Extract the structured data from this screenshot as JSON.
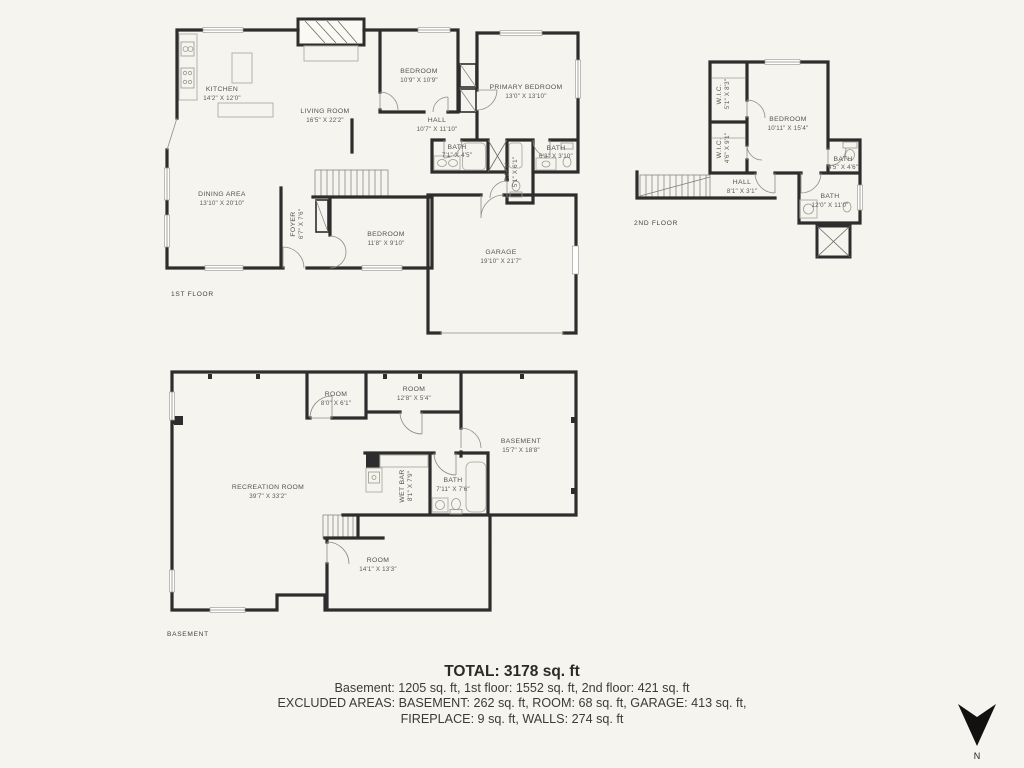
{
  "colors": {
    "background": "#f5f4ee",
    "wall": "#2d2d2d",
    "room_label": "#54544c"
  },
  "floors": {
    "first": {
      "label": "1ST FLOOR",
      "rooms": [
        {
          "name": "KITCHEN",
          "dims": "14'2\" X 12'0\""
        },
        {
          "name": "LIVING ROOM",
          "dims": "16'5\" X 22'2\""
        },
        {
          "name": "DINING AREA",
          "dims": "13'10\" X 20'10\""
        },
        {
          "name": "FOYER",
          "dims": "6'7\" X 7'6\""
        },
        {
          "name": "BEDROOM",
          "dims": "11'8\" X 9'10\""
        },
        {
          "name": "BEDROOM",
          "dims": "10'9\" X 10'9\""
        },
        {
          "name": "PRIMARY BEDROOM",
          "dims": "13'0\" X 13'10\""
        },
        {
          "name": "HALL",
          "dims": "10'7\" X 11'10\""
        },
        {
          "name": "BATH",
          "dims": "7'1\" X 4'5\""
        },
        {
          "name": "BATH",
          "dims": "5'1\" X 6'1\""
        },
        {
          "name": "BATH",
          "dims": "6'3\" X 3'10\""
        },
        {
          "name": "GARAGE",
          "dims": "19'10\" X 21'7\""
        }
      ]
    },
    "second": {
      "label": "2ND FLOOR",
      "rooms": [
        {
          "name": "W.I.C.",
          "dims": "5'1\" X 8'3\""
        },
        {
          "name": "W.I.C.",
          "dims": "4'6\" X 9'1\""
        },
        {
          "name": "BEDROOM",
          "dims": "10'11\" X 15'4\""
        },
        {
          "name": "HALL",
          "dims": "8'1\" X 3'1\""
        },
        {
          "name": "BATH",
          "dims": "4'5\" X 4'6\""
        },
        {
          "name": "BATH",
          "dims": "12'0\" X 11'0\""
        }
      ]
    },
    "basement": {
      "label": "BASEMENT",
      "rooms": [
        {
          "name": "ROOM",
          "dims": "8'0\" X 6'1\""
        },
        {
          "name": "ROOM",
          "dims": "12'8\" X 5'4\""
        },
        {
          "name": "RECREATION ROOM",
          "dims": "39'7\" X 33'2\""
        },
        {
          "name": "WET BAR",
          "dims": "8'1\" X 7'9\""
        },
        {
          "name": "BATH",
          "dims": "7'11\" X 7'6\""
        },
        {
          "name": "BASEMENT",
          "dims": "15'7\" X 18'8\""
        },
        {
          "name": "ROOM",
          "dims": "14'1\" X 13'3\""
        }
      ]
    }
  },
  "summary": {
    "total": "TOTAL: 3178 sq. ft",
    "line1": "Basement: 1205 sq. ft, 1st floor: 1552 sq. ft, 2nd floor: 421 sq. ft",
    "line2": "EXCLUDED AREAS: BASEMENT: 262 sq. ft, ROOM: 68 sq. ft, GARAGE: 413 sq. ft,",
    "line3": "FIREPLACE: 9 sq. ft, WALLS: 274 sq. ft"
  },
  "compass": {
    "label": "N"
  }
}
